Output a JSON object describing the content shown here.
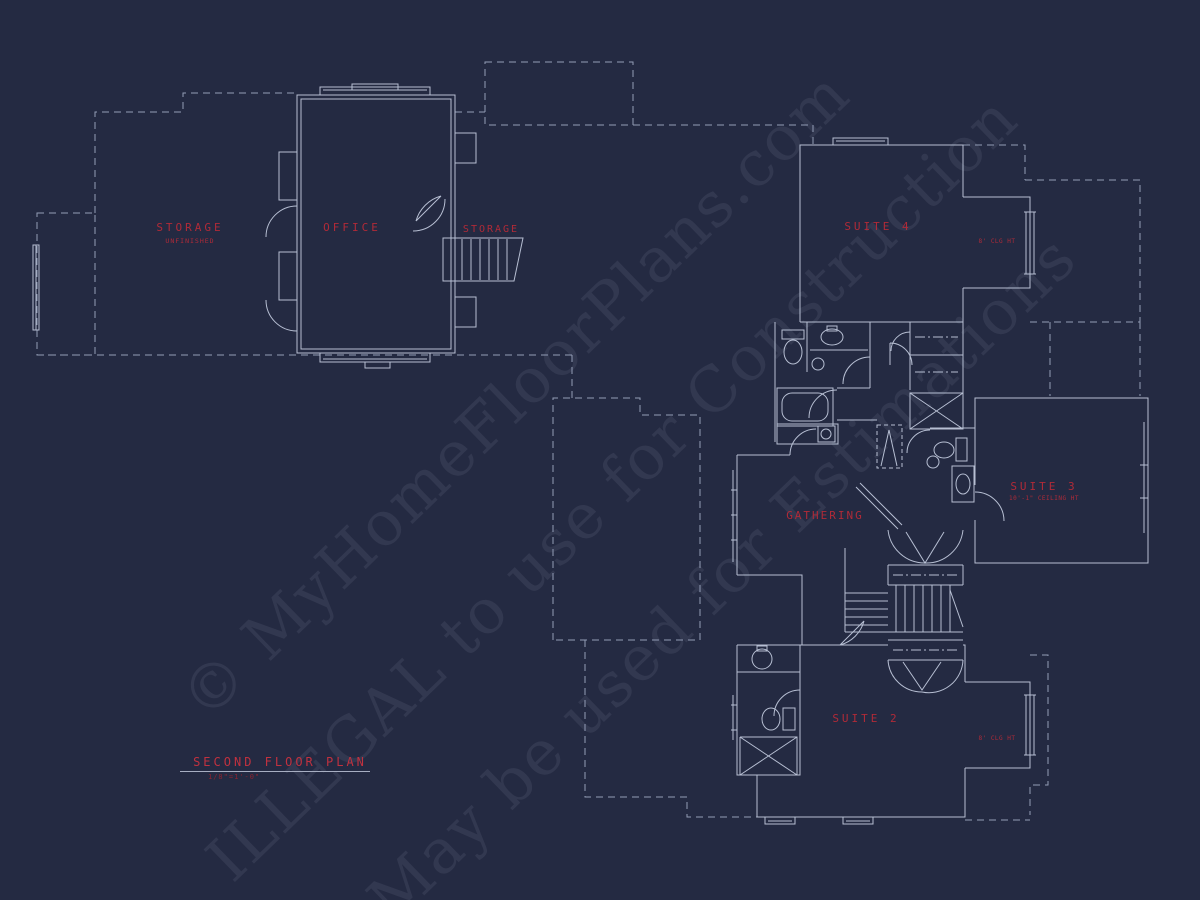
{
  "drawing": {
    "type": "architectural-floor-plan",
    "sheet_background": "#242a42",
    "line_color_solid": "#b7bfd3",
    "line_color_dashed": "#939db6",
    "label_color": "#b02a38",
    "title_color": "#c0313f"
  },
  "title_block": {
    "title": "SECOND FLOOR PLAN",
    "scale": "1/8\"=1'-0\""
  },
  "watermark": {
    "lines": [
      "© MyHomeFloorPlans.com",
      "ILLEGAL to use for Construction",
      "May be used for Estimations"
    ]
  },
  "labels": [
    {
      "id": "storage-unfinished",
      "text": "STORAGE",
      "x": 190,
      "y": 231,
      "size": 11,
      "ls": 3
    },
    {
      "id": "storage-unfinished-sub",
      "text": "UNFINISHED",
      "x": 190,
      "y": 243,
      "size": 6.5,
      "ls": 1
    },
    {
      "id": "office",
      "text": "OFFICE",
      "x": 352,
      "y": 231,
      "size": 11,
      "ls": 3
    },
    {
      "id": "storage-stairs",
      "text": "STORAGE",
      "x": 491,
      "y": 232,
      "size": 10,
      "ls": 2
    },
    {
      "id": "suite-4",
      "text": "SUITE 4",
      "x": 878,
      "y": 230,
      "size": 11,
      "ls": 3
    },
    {
      "id": "suite-4-clg",
      "text": "8' CLG HT",
      "x": 997,
      "y": 243,
      "size": 6,
      "ls": 0.5
    },
    {
      "id": "gathering",
      "text": "GATHERING",
      "x": 825,
      "y": 519,
      "size": 11,
      "ls": 2
    },
    {
      "id": "suite-3",
      "text": "SUITE 3",
      "x": 1044,
      "y": 490,
      "size": 11,
      "ls": 3
    },
    {
      "id": "suite-3-clg",
      "text": "10'-1\" CEILING HT",
      "x": 1044,
      "y": 500,
      "size": 6,
      "ls": 0.5
    },
    {
      "id": "suite-2",
      "text": "SUITE 2",
      "x": 866,
      "y": 722,
      "size": 11,
      "ls": 3
    },
    {
      "id": "suite-2-clg",
      "text": "8' CLG HT",
      "x": 997,
      "y": 740,
      "size": 6,
      "ls": 0.5
    }
  ]
}
